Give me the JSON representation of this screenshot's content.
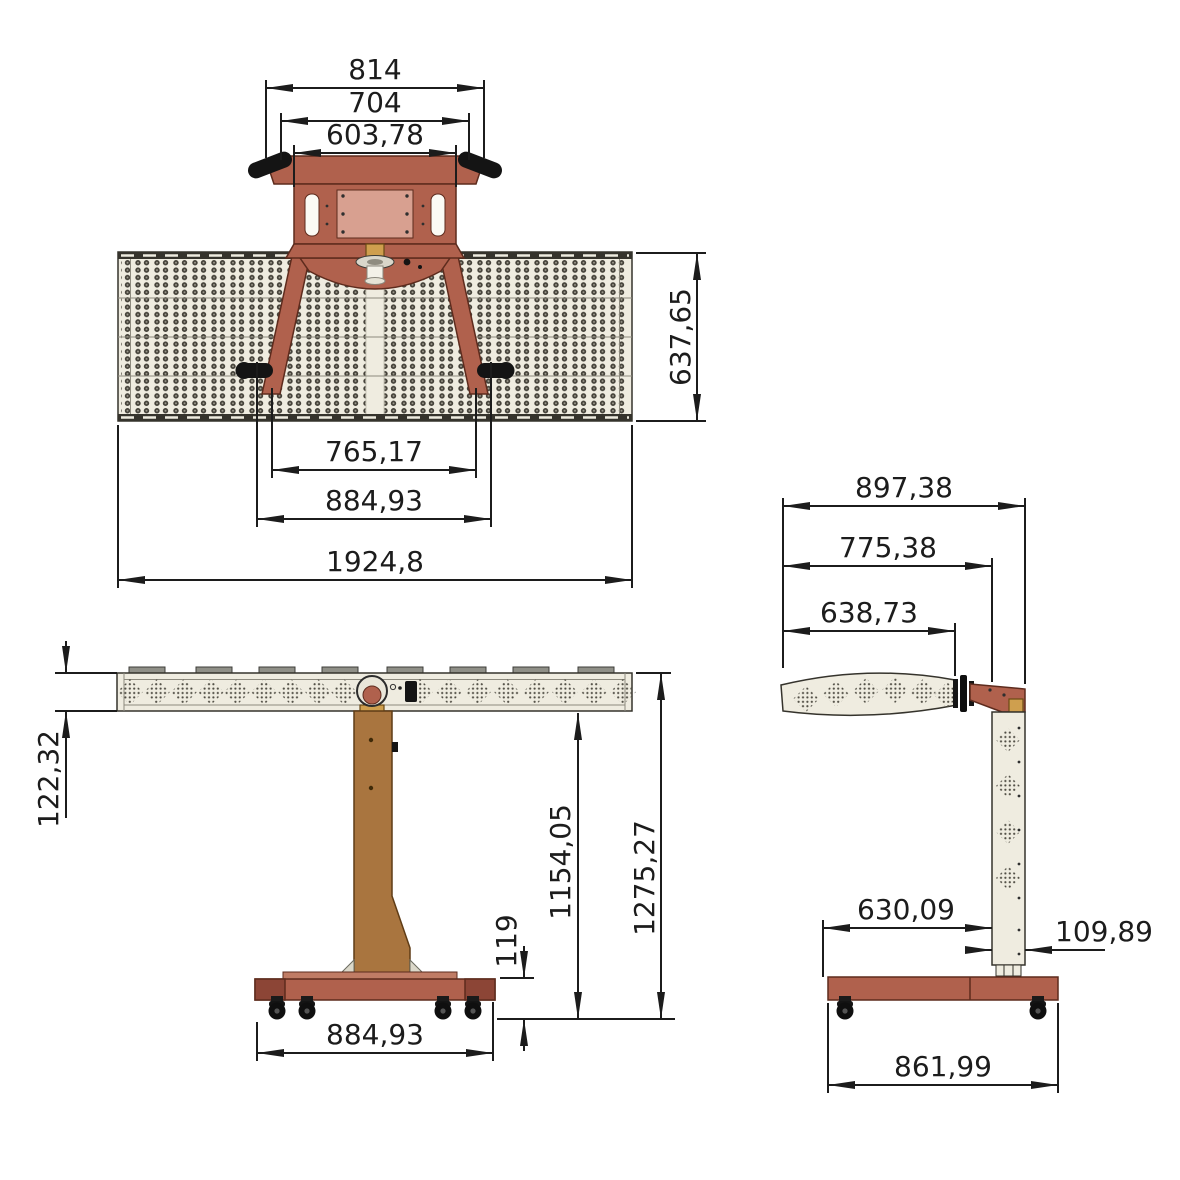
{
  "canvas": {
    "width": 1180,
    "height": 1180,
    "background": "#ffffff"
  },
  "colors": {
    "line": "#1c1c1c",
    "frame_red": "#b0614d",
    "frame_red_dark": "#5d2b1d",
    "frame_red_cap": "#8c4536",
    "post_brown": "#a9753f",
    "post_brown_dark": "#5f3c16",
    "gold": "#cf9f4e",
    "panel_cream": "#efece0",
    "panel_stroke": "#35332c",
    "wheel_black": "#141414",
    "lamp_dot": "#45423a",
    "vent_dot": "#504d44"
  },
  "views": {
    "top": {
      "dims": {
        "bracket_outer_width": "814",
        "bracket_mid_width": "704",
        "bracket_inner_width": "603,78",
        "panel_depth": "637,65",
        "legs_inner_span": "765,17",
        "legs_outer_span": "884,93",
        "overall_width": "1924,8"
      }
    },
    "front": {
      "dims": {
        "panel_thickness": "122,32",
        "underside_height": "1154,05",
        "overall_height": "1275,27",
        "base_height": "119",
        "base_width": "884,93"
      }
    },
    "side": {
      "dims": {
        "overall_depth": "897,38",
        "pivot_depth": "775,38",
        "panel_depth": "638,73",
        "base_front_depth": "630,09",
        "column_depth": "109,89",
        "base_depth": "861,99"
      }
    }
  }
}
